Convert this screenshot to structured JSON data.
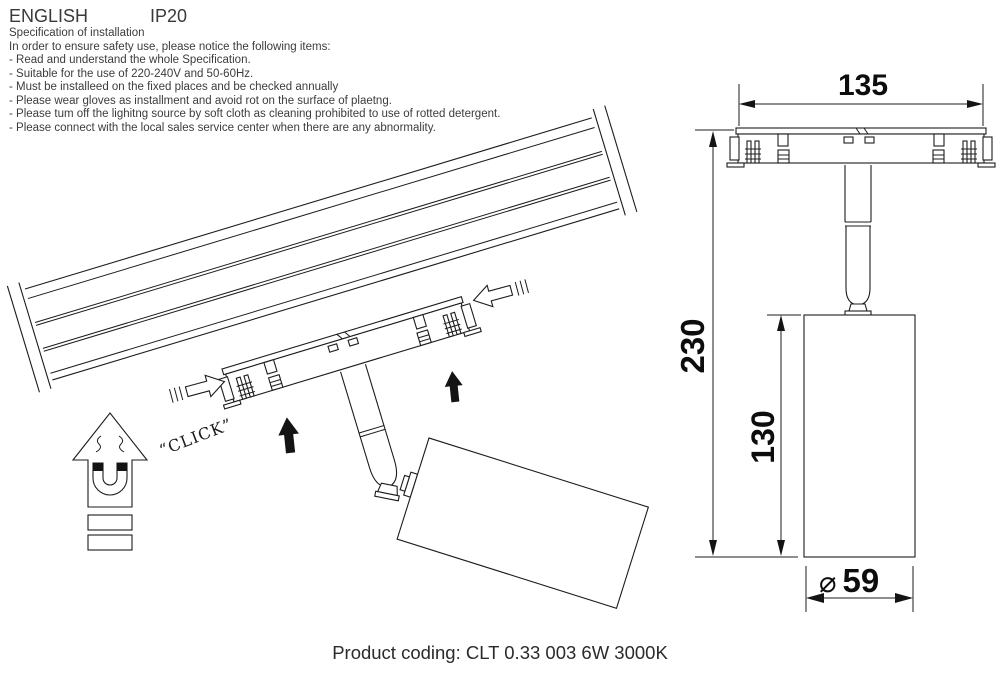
{
  "header": {
    "language": "ENGLISH",
    "ip_rating": "IP20"
  },
  "spec": {
    "title": "Specification of installation",
    "intro": "In order to ensure safety use, please notice the following items:",
    "items": [
      "- Read and understand the whole Specification.",
      "- Suitable for the use of 220-240V and 50-60Hz.",
      "- Must be installeed on the fixed places and be checked annually",
      "- Please wear gloves as installment and avoid rot on the surface of plaetng.",
      "- Please tum off the lighitng source by soft cloth as cleaning prohibited to use of rotted detergent.",
      "- Please connect with the local sales service center when there are any abnormality."
    ]
  },
  "installation_diagram": {
    "click_label": "“CLICK”"
  },
  "dimension_diagram": {
    "width_mm": "135",
    "overall_height_mm": "230",
    "body_height_mm": "130",
    "diameter_symbol": "⌀",
    "diameter_mm": "59"
  },
  "footer": {
    "product_coding": "Product coding: CLT 0.33 003 6W 3000K"
  }
}
